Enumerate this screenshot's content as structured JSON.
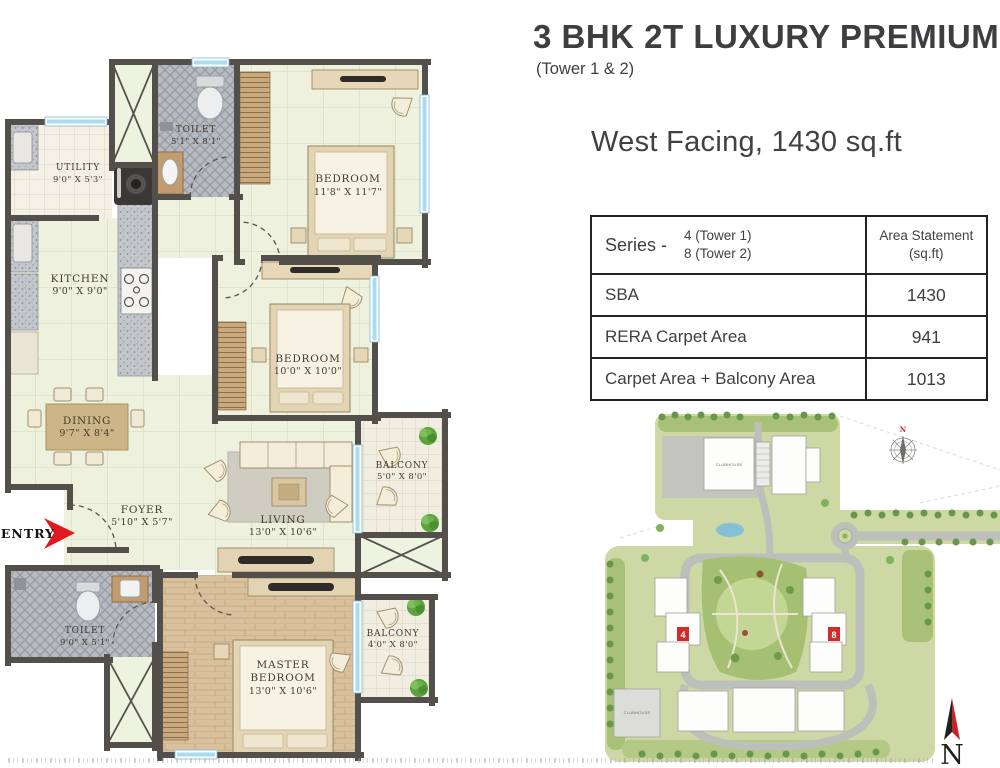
{
  "header": {
    "title": "3 BHK 2T LUXURY PREMIUM",
    "subtitle": "(Tower 1 & 2)",
    "facing": "West Facing, 1430 sq.ft"
  },
  "area_table": {
    "series_label": "Series -",
    "series_lines": [
      "4 (Tower 1)",
      "8 (Tower 2)"
    ],
    "value_header_lines": [
      "Area Statement",
      "(sq.ft)"
    ],
    "rows": [
      {
        "label": "SBA",
        "value": "1430"
      },
      {
        "label": "RERA Carpet Area",
        "value": "941"
      },
      {
        "label": "Carpet Area + Balcony Area",
        "value": "1013"
      }
    ]
  },
  "floor_plan": {
    "entry": "ENTRY",
    "rooms": {
      "toilet_top": {
        "name": "TOILET",
        "dims": "5'1\" X 8'1\""
      },
      "bedroom1": {
        "name": "BEDROOM",
        "dims": "11'8\" X 11'7\""
      },
      "utility": {
        "name": "UTILITY",
        "dims": "9'0\" X 5'3\""
      },
      "kitchen": {
        "name": "KITCHEN",
        "dims": "9'0\" X 9'0\""
      },
      "bedroom2": {
        "name": "BEDROOM",
        "dims": "10'0\" X 10'0\""
      },
      "dining": {
        "name": "DINING",
        "dims": "9'7\" X 8'4\""
      },
      "foyer": {
        "name": "FOYER",
        "dims": "5'10\" X 5'7\""
      },
      "living": {
        "name": "LIVING",
        "dims": "13'0\" X 10'6\""
      },
      "balcony1": {
        "name": "BALCONY",
        "dims": "5'0\" X 8'0\""
      },
      "toilet_bottom": {
        "name": "TOILET",
        "dims": "9'0\" X 5'1\""
      },
      "master": {
        "name_line1": "MASTER",
        "name_line2": "BEDROOM",
        "dims": "13'0\" X 10'6\""
      },
      "balcony2": {
        "name": "BALCONY",
        "dims": "4'0\" X 8'0\""
      }
    }
  },
  "site_plan": {
    "clubhouse": "CLUBHOUSE",
    "tower1_marker": "4",
    "tower2_marker": "8",
    "compass_n": "N",
    "north_label": "N"
  },
  "colors": {
    "accent_red": "#e0191f",
    "wall": "#53504c",
    "window_blue": "#aadcf0"
  }
}
